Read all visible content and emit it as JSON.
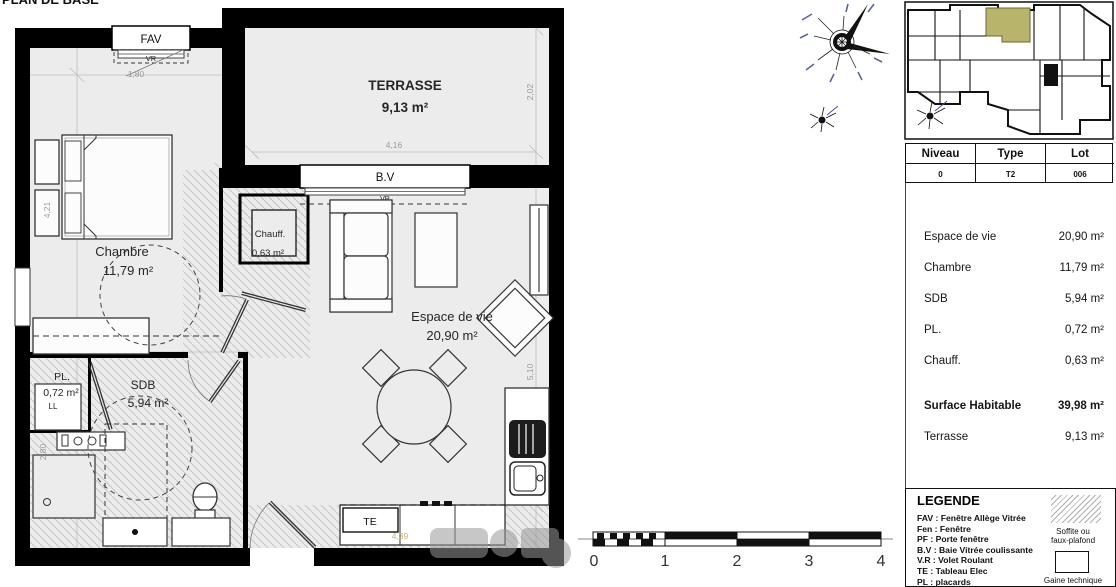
{
  "colors": {
    "floor": "#ececec",
    "wall": "#000000",
    "hatch_line": "#c6c6c6",
    "dim_text": "#9b9b9b",
    "unit_highlight": "#b9b46c",
    "faint_dim": "#c9ae7c",
    "watermark": "#9a9a9a"
  },
  "plan": {
    "clipped_title": "PLAN DE BASE",
    "rooms": {
      "terrasse": {
        "name": "TERRASSE",
        "area": "9,13 m²"
      },
      "chambre": {
        "name": "Chambre",
        "area": "11,79 m²"
      },
      "espace": {
        "name": "Espace de vie",
        "area": "20,90 m²"
      },
      "sdb": {
        "name": "SDB",
        "area": "5,94 m²"
      },
      "pl": {
        "name": "PL.",
        "area": "0,72 m²",
        "sub": "LL"
      },
      "chauff": {
        "name": "Chauff.",
        "area": "0,63 m²"
      }
    },
    "labels": {
      "fav": "FAV",
      "vr": "VR",
      "bv": "B.V",
      "te": "TE"
    },
    "dims": {
      "d180": "1,80",
      "d421": "4,21",
      "d280": "2,80",
      "d416": "4,16",
      "d202": "2,02",
      "d510": "5,10",
      "d439": "4,39"
    }
  },
  "info_table": {
    "headers": [
      "Niveau",
      "Type",
      "Lot"
    ],
    "row": [
      "0",
      "T2",
      "006"
    ]
  },
  "areas": {
    "rows": [
      {
        "label": "Espace de vie",
        "value": "20,90 m²"
      },
      {
        "label": "Chambre",
        "value": "11,79 m²"
      },
      {
        "label": "SDB",
        "value": "5,94 m²"
      },
      {
        "label": "PL.",
        "value": "0,72 m²"
      },
      {
        "label": "Chauff.",
        "value": "0,63 m²"
      }
    ],
    "total": {
      "label": "Surface Habitable",
      "value": "39,98 m²"
    },
    "terrasse": {
      "label": "Terrasse",
      "value": "9,13 m²"
    }
  },
  "legend": {
    "title": "LEGENDE",
    "items": [
      "FAV : Fenêtre Allège Vitrée",
      "Fen : Fenêtre",
      "PF : Porte fenêtre",
      "B.V : Baie Vitrée coulissante",
      "V.R : Volet Roulant",
      "TE : Tableau Elec",
      "PL : placards"
    ],
    "soffit_caption_1": "Soffite ou",
    "soffit_caption_2": "faux-plafond",
    "gaine_caption": "Gaine technique"
  },
  "scalebar": {
    "t0": "0",
    "t1": "1",
    "t2": "2",
    "t3": "3",
    "t4": "4"
  }
}
